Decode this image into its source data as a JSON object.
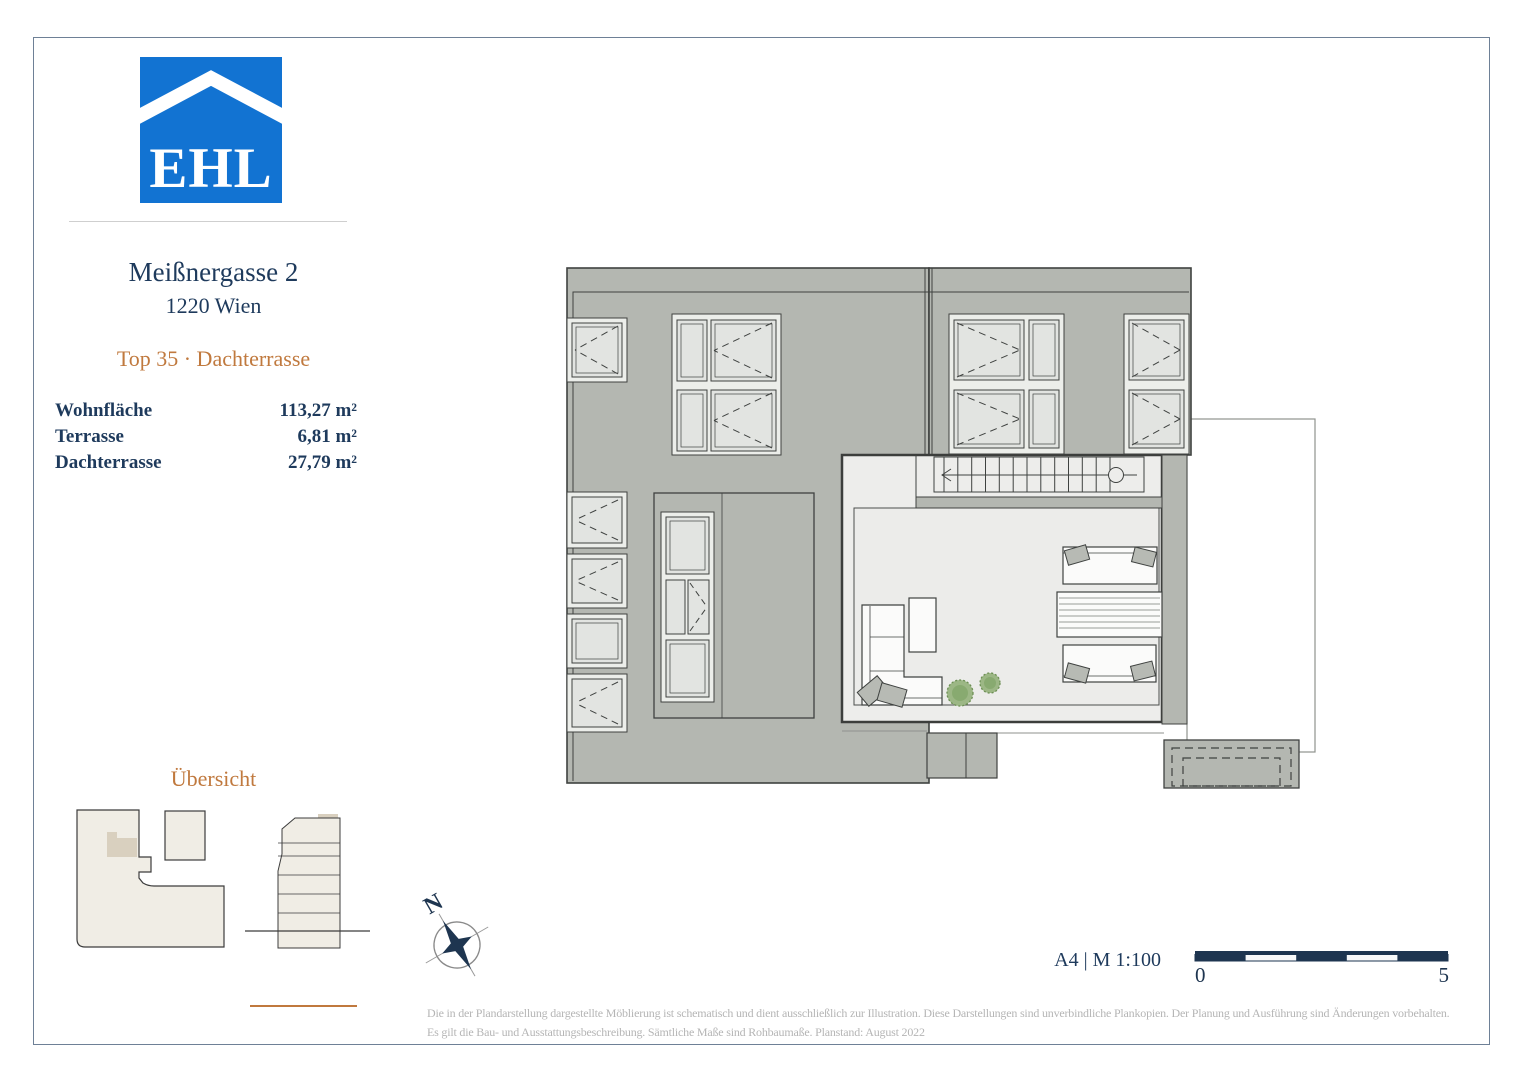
{
  "brand": {
    "logo_text": "EHL",
    "logo_color": "#1273d2"
  },
  "header": {
    "address_line1": "Meißnergasse 2",
    "address_line2": "1220 Wien",
    "unit_title": "Top 35 · Dachterrasse"
  },
  "areas": {
    "rows": [
      {
        "label": "Wohnfläche",
        "value": "113,27 m²"
      },
      {
        "label": "Terrasse",
        "value": "6,81 m²"
      },
      {
        "label": "Dachterrasse",
        "value": "27,79 m²"
      }
    ]
  },
  "overview": {
    "title": "Übersicht"
  },
  "plan": {
    "compass_north_label": "N",
    "level_name": "Dachterrasse"
  },
  "scale": {
    "format_text": "A4 | M 1:100",
    "bar_start_label": "0",
    "bar_end_label": "5"
  },
  "disclaimer": {
    "line1": "Die in der Plandarstellung dargestellte Möblierung ist schematisch und dient ausschließlich zur Illustration. Diese Darstellungen sind unverbindliche Plankopien. Der Planung und Ausführung sind Änderungen vorbehalten.",
    "line2": "Es gilt die Bau- und Ausstattungsbeschreibung. Sämtliche Maße sind Rohbaumaße. Planstand: August 2022"
  },
  "colors": {
    "brand_blue": "#1273d2",
    "navy_text": "#1e3a5c",
    "accent_orange": "#c0793e",
    "roof_grey": "#b4b7b1",
    "floor_light": "#ededeb",
    "site_beige": "#f0ede5",
    "unit_highlight": "#d9d0bf"
  }
}
